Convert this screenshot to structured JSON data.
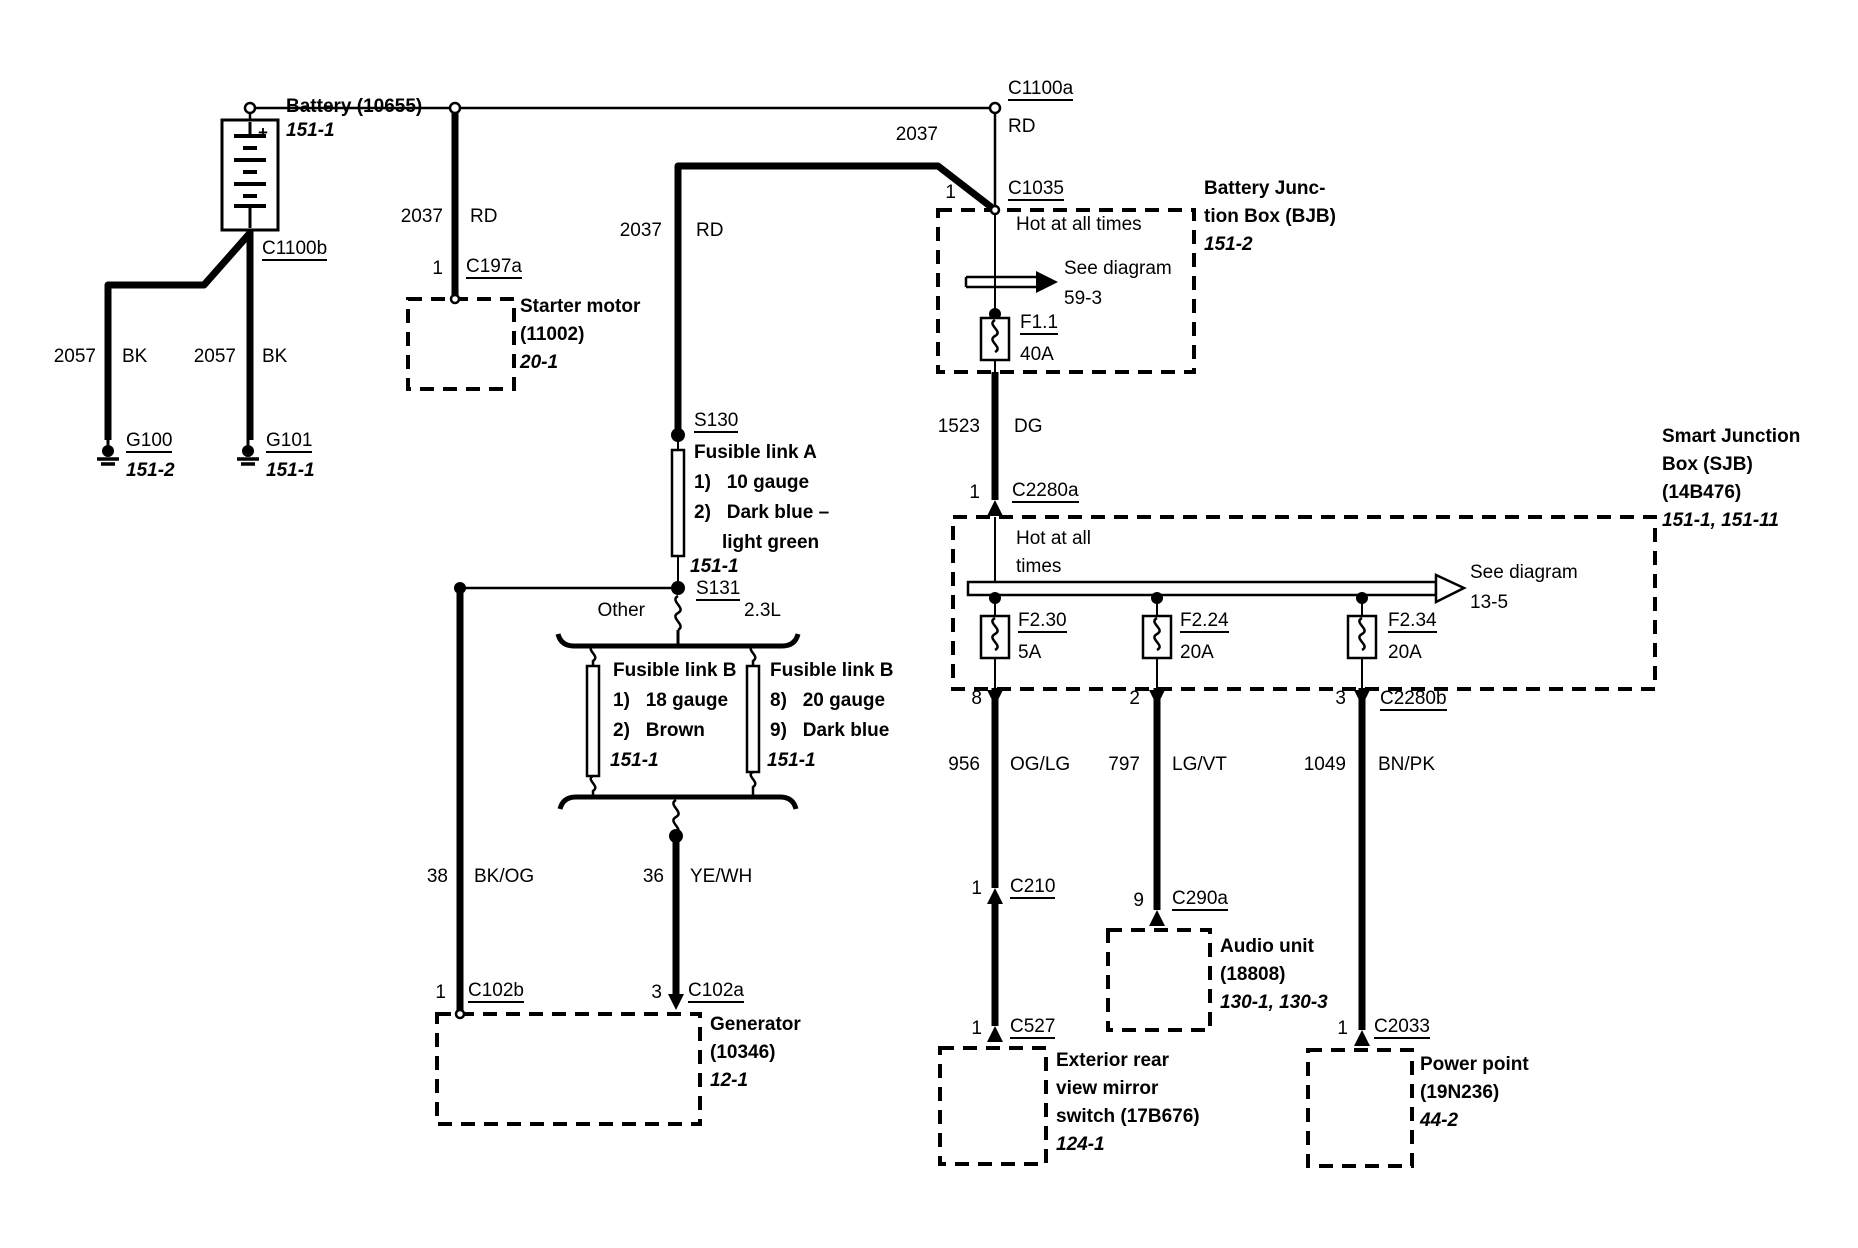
{
  "colors": {
    "ink": "#000000",
    "paper": "#ffffff"
  },
  "battery": {
    "title": "Battery (10655)",
    "ref": "151-1",
    "plus": "+",
    "minus": "-",
    "conn_bottom": "C1100b"
  },
  "grounds": {
    "left": {
      "num": "2057",
      "color": "BK",
      "id": "G100",
      "ref": "151-2"
    },
    "right": {
      "num": "2057",
      "color": "BK",
      "id": "G101",
      "ref": "151-1"
    }
  },
  "starter": {
    "num": "2037",
    "color": "RD",
    "pin": "1",
    "conn": "C197a",
    "name": "Starter motor",
    "part": "(11002)",
    "ref": "20-1"
  },
  "feed": {
    "num": "2037",
    "color": "RD"
  },
  "bjb_in": {
    "conn_top": "C1100a",
    "color": "RD",
    "num": "2037",
    "pin": "1",
    "conn": "C1035"
  },
  "bjb": {
    "hot": "Hot at all times",
    "see_1": "See diagram",
    "see_2": "59-3",
    "fuse": "F1.1",
    "amps": "40A",
    "name_1": "Battery Junc-",
    "name_2": "tion Box (BJB)",
    "ref": "151-2"
  },
  "bjb_out": {
    "num": "1523",
    "color": "DG",
    "pin": "1",
    "conn": "C2280a"
  },
  "sjb": {
    "hot_1": "Hot at all",
    "hot_2": "times",
    "see_1": "See diagram",
    "see_2": "13-5",
    "fuses": [
      {
        "id": "F2.30",
        "amps": "5A"
      },
      {
        "id": "F2.24",
        "amps": "20A"
      },
      {
        "id": "F2.34",
        "amps": "20A"
      }
    ],
    "name_1": "Smart Junction",
    "name_2": "Box (SJB)",
    "name_3": "(14B476)",
    "ref": "151-1, 151-11",
    "pin_1": "8",
    "pin_2": "2",
    "pin_3": "3",
    "conn_out": "C2280b"
  },
  "mirror_branch": {
    "num": "956",
    "color": "OG/LG",
    "pin_a": "1",
    "conn_a": "C210",
    "pin_b": "1",
    "conn_b": "C527",
    "name_1": "Exterior rear",
    "name_2": "view mirror",
    "name_3": "switch (17B676)",
    "ref": "124-1"
  },
  "audio_branch": {
    "num": "797",
    "color": "LG/VT",
    "pin": "9",
    "conn": "C290a",
    "name_1": "Audio unit",
    "name_2": "(18808)",
    "ref": "130-1, 130-3"
  },
  "power_branch": {
    "num": "1049",
    "color": "BN/PK",
    "pin": "1",
    "conn": "C2033",
    "name_1": "Power point",
    "name_2": "(19N236)",
    "ref": "44-2"
  },
  "link_a": {
    "splice_top": "S130",
    "title": "Fusible link A",
    "item_1": "1)   10 gauge",
    "item_2": "2)   Dark blue –",
    "item_2b": "light green",
    "ref": "151-1",
    "splice_bottom": "S131"
  },
  "split": {
    "left": "Other",
    "right": "2.3L"
  },
  "link_b_left": {
    "title": "Fusible link B",
    "item_1": "1)   18 gauge",
    "item_2": "2)   Brown",
    "ref": "151-1",
    "num": "38",
    "color": "BK/OG"
  },
  "link_b_right": {
    "title": "Fusible link B",
    "item_1": "8)   20 gauge",
    "item_2": "9)   Dark blue",
    "ref": "151-1",
    "num": "36",
    "color": "YE/WH"
  },
  "generator": {
    "pin_a": "1",
    "conn_a": "C102b",
    "pin_b": "3",
    "conn_b": "C102a",
    "name_1": "Generator",
    "name_2": "(10346)",
    "ref": "12-1"
  }
}
